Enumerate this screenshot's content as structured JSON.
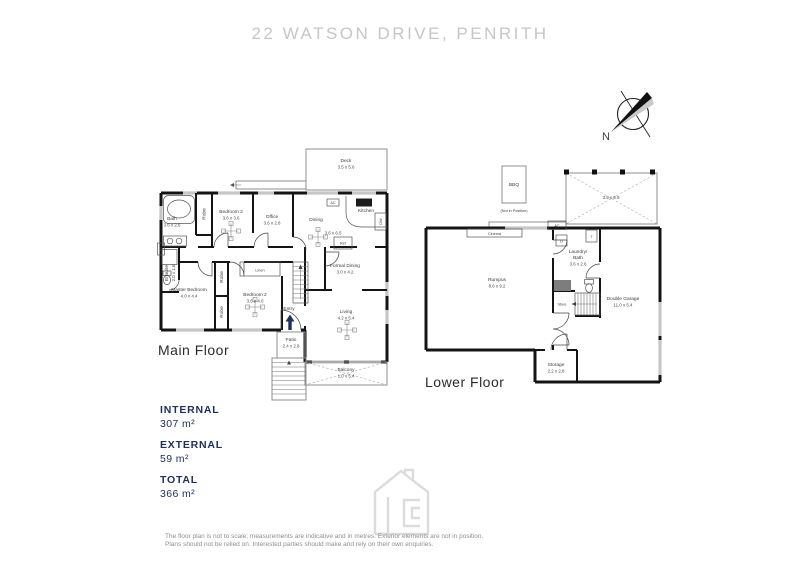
{
  "title": "22 WATSON DRIVE, PENRITH",
  "compass": {
    "north_label": "N"
  },
  "main_floor": {
    "floor_label": "Main Floor",
    "deck": {
      "name": "Deck",
      "dim": "3.5 x 5.6"
    },
    "bath": {
      "name": "Bath",
      "dim": "3.6 x 2.6"
    },
    "robe_1": "Robe",
    "bedroom3": {
      "name": "Bedroom 3",
      "dim": "3.6 x 3.6"
    },
    "office": {
      "name": "Office",
      "dim": "3.6 x 2.8"
    },
    "dining": {
      "name": "Dining",
      "dim": "3.6 x 6.5"
    },
    "kitchen": {
      "name": "Kitchen"
    },
    "ref_label": "Ref",
    "dw_label": "DW",
    "ac_top": "AC",
    "ac_left": "AC",
    "ensuite": {
      "name": "Ensuite",
      "dim": "2.0 x 1.6"
    },
    "master_bedroom": {
      "name": "Master Bedroom",
      "dim": "4.0 x 4.4"
    },
    "robe_2": "Robe",
    "robe_3": "Robe",
    "linen": "Linen",
    "bedroom2": {
      "name": "Bedroom 2",
      "dim": "3.6 x 4.0"
    },
    "entry": "Entry",
    "formal_dining": {
      "name": "Formal Dining",
      "dim": "3.0 x 4.2"
    },
    "living": {
      "name": "Living",
      "dim": "4.2 x 5.4"
    },
    "patio": {
      "name": "Patio",
      "dim": "2.4 x 2.8"
    },
    "balcony": {
      "name": "Balcony",
      "dim": "1.0 x 5.4"
    }
  },
  "lower_floor": {
    "floor_label": "Lower Floor",
    "bbq": {
      "name": "BBQ",
      "note": "(Not in Position)"
    },
    "pergola_dim": "3.5 x 8.9",
    "ac": "AC",
    "cinema": "Cinema",
    "rumpus": {
      "name": "Rumpus",
      "dim": "8.6 x 9.2"
    },
    "laundry": {
      "line1": "Laundry/",
      "line2": "Bath",
      "dim": "3.6 x 2.6"
    },
    "dryer_label": "D",
    "tub_label": "T",
    "store": "Store",
    "double_garage": {
      "name": "Double Garage",
      "dim": "11.0 x 5.4"
    },
    "storage": {
      "name": "Storage",
      "dim": "2.2 x 2.8"
    }
  },
  "areas": {
    "internal_label": "INTERNAL",
    "internal_value": "307 m²",
    "external_label": "EXTERNAL",
    "external_value": "59 m²",
    "total_label": "TOTAL",
    "total_value": "366 m²",
    "accent_color": "#20305c"
  },
  "disclaimer": {
    "line1": "The floor plan is not to scale; measurements are indicative and in metres. Exterior elements are not in position.",
    "line2": "Plans should not be relied on. Interested parties should make and rely on their own enquiries."
  }
}
